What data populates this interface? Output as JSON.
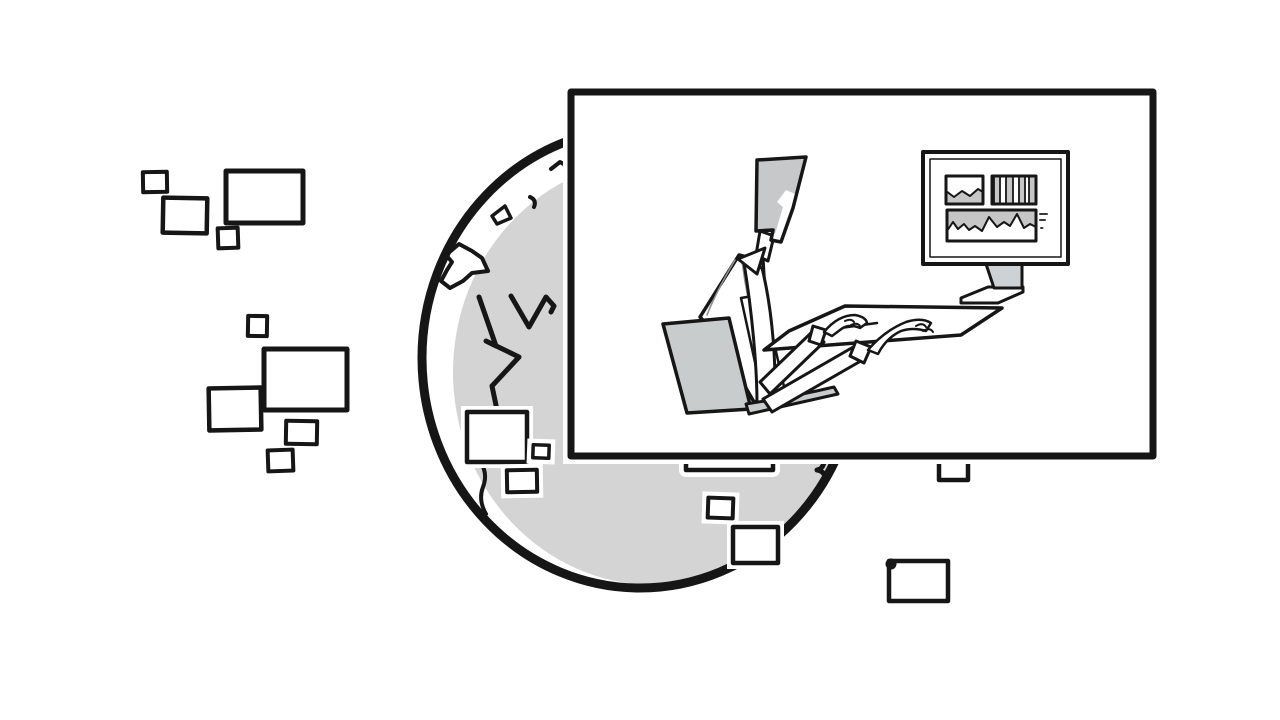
{
  "scene": {
    "description": "Black-and-white hand-drawn illustration: a shaded globe surrounded by floating blank screens, with a large inset panel showing a person seated at a desk typing at a computer whose monitor displays small charts",
    "style": "sketch / line-art cartoon"
  },
  "colors": {
    "background": "#ffffff",
    "ink": "#161616",
    "globe_gray": "#d4d4d4",
    "panel_white": "#ffffff",
    "chair_gray": "#c9cccd",
    "hair_gray": "#c6c8ca",
    "stand_gray": "#ced2d4",
    "chart_gray": "#c6c6c6",
    "stripe_gray": "#8f8f8f",
    "mark_gray": "#3a3a3a"
  },
  "globe": {
    "cx": 640,
    "cy": 358,
    "rx": 218,
    "ry": 230
  },
  "inset_panel": {
    "x": 571,
    "y": 92,
    "width": 582,
    "height": 364
  },
  "monitor_doodles": [
    "area-chart",
    "bar-chart",
    "line-chart"
  ],
  "floating_screens": [
    {
      "x": 143,
      "y": 172,
      "w": 24,
      "h": 20,
      "rot": -1,
      "sw": 4
    },
    {
      "x": 163,
      "y": 198,
      "w": 44,
      "h": 35,
      "rot": 1,
      "sw": 4.5
    },
    {
      "x": 226,
      "y": 171,
      "w": 77,
      "h": 52,
      "rot": 0,
      "sw": 5
    },
    {
      "x": 218,
      "y": 228,
      "w": 20,
      "h": 20,
      "rot": -2,
      "sw": 4
    },
    {
      "x": 248,
      "y": 316,
      "w": 19,
      "h": 20,
      "rot": 1,
      "sw": 4
    },
    {
      "x": 264,
      "y": 349,
      "w": 83,
      "h": 61,
      "rot": 0,
      "sw": 5
    },
    {
      "x": 209,
      "y": 388,
      "w": 52,
      "h": 42,
      "rot": -1,
      "sw": 4.5
    },
    {
      "x": 286,
      "y": 421,
      "w": 31,
      "h": 23,
      "rot": 1,
      "sw": 4
    },
    {
      "x": 268,
      "y": 450,
      "w": 25,
      "h": 21,
      "rot": -2,
      "sw": 4
    },
    {
      "x": 467,
      "y": 412,
      "w": 60,
      "h": 50,
      "rot": 0,
      "sw": 4.5,
      "halo": true
    },
    {
      "x": 533,
      "y": 445,
      "w": 16,
      "h": 13,
      "rot": 2,
      "sw": 3.5,
      "halo": true
    },
    {
      "x": 507,
      "y": 470,
      "w": 30,
      "h": 22,
      "rot": -1,
      "sw": 4,
      "halo": true
    },
    {
      "x": 708,
      "y": 498,
      "w": 25,
      "h": 20,
      "rot": 2,
      "sw": 4,
      "halo": true
    },
    {
      "x": 733,
      "y": 527,
      "w": 45,
      "h": 36,
      "rot": 0,
      "sw": 4.5,
      "halo": true
    },
    {
      "x": 889,
      "y": 561,
      "w": 59,
      "h": 40,
      "rot": 0,
      "sw": 4.5
    }
  ]
}
